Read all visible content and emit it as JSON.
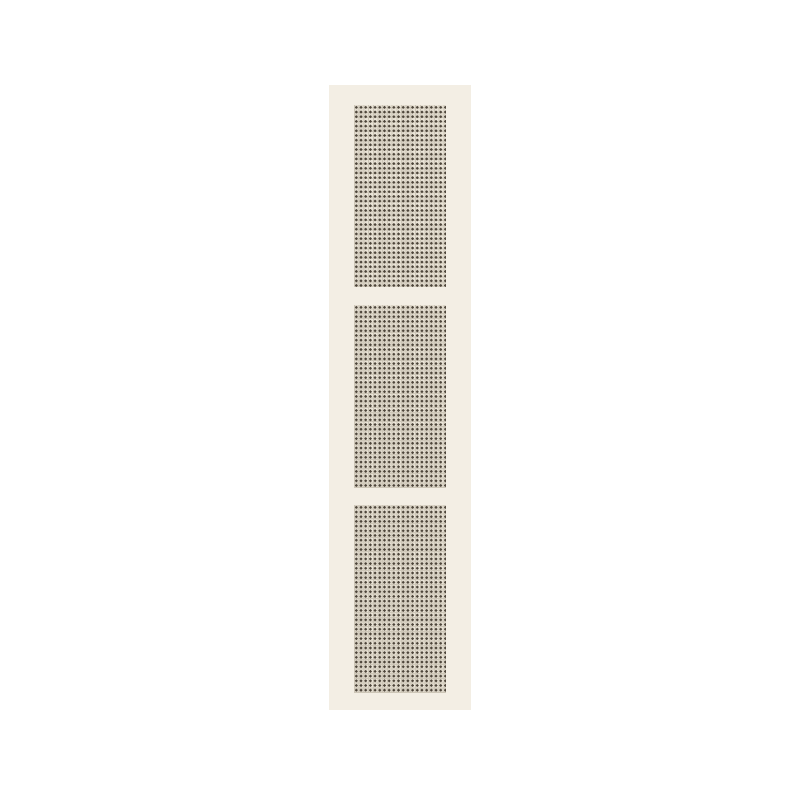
{
  "page": {
    "background_color": "#ffffff"
  },
  "panel": {
    "background_color": "#f3eee4",
    "mesh": {
      "background_color": "#eae4d7",
      "dot_color": "#4d453a",
      "dot_color_alt": "#7a6f5e",
      "thread_color": "#cdc6b7",
      "dot_pitch_px": 4.7
    },
    "mesh_blocks": [
      {
        "name": "mesh-insert-top"
      },
      {
        "name": "mesh-insert-middle"
      },
      {
        "name": "mesh-insert-bottom"
      }
    ]
  }
}
